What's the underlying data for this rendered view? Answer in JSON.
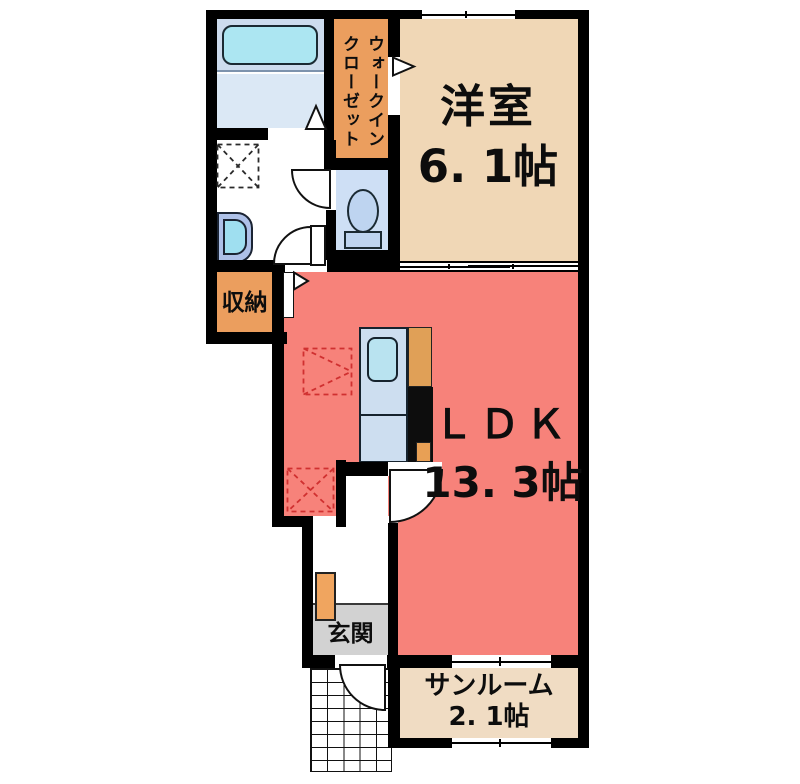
{
  "plan": {
    "type": "apartment-floorplan",
    "rooms": {
      "western_room": {
        "label": "洋室",
        "size": "6. 1帖"
      },
      "ldk": {
        "label": "ＬＤＫ",
        "size": "13. 3帖"
      },
      "sunroom": {
        "label": "サンルーム",
        "size": "2. 1帖"
      },
      "walk_in_closet": {
        "line1": "ウォークイン",
        "line2": "クローゼット"
      },
      "storage": {
        "label": "収納"
      },
      "entrance": {
        "label": "玄関"
      }
    },
    "fixtures": [
      "bathtub",
      "unit-bath",
      "washbasin",
      "washing-machine-space",
      "toilet",
      "kitchen-counter",
      "kitchen-sink",
      "refrigerator-space",
      "shoe-cabinet",
      "exterior-stairs"
    ],
    "symbols": [
      "door-swing-arc",
      "door-direction-triangle",
      "dashed-placement-square",
      "sliding-door",
      "window"
    ],
    "colors": {
      "wall": "#000000",
      "western_room": "#f0d7b6",
      "ldk": "#f7827a",
      "sunroom": "#f0dcc3",
      "closet_storage": "#eb9e5e",
      "bathroom_upper": "#cddcee",
      "bathroom_lower": "#dbe8f5",
      "bathtub": "#ace6f2",
      "toilet_room": "#cedff5",
      "kitchen_counter": "#cddef0",
      "entrance_floor": "#d2d2d2",
      "placement_dash_red": "#d03030"
    }
  }
}
